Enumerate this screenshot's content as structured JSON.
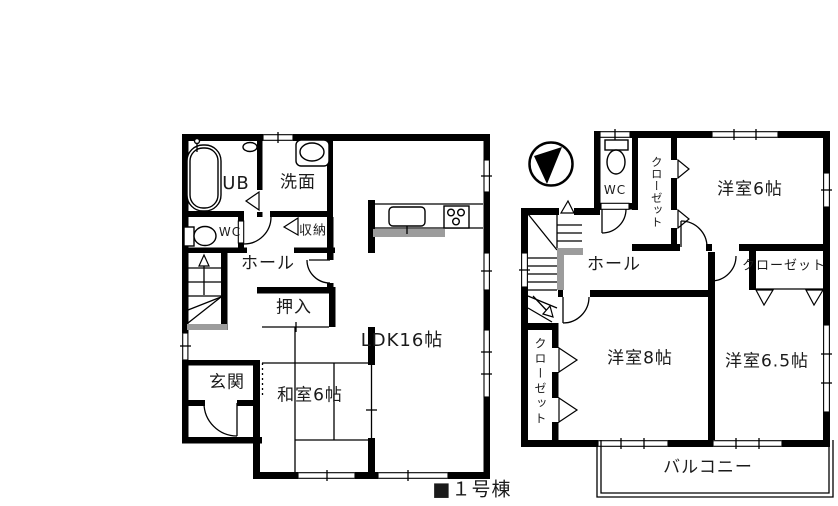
{
  "caption": "■１号棟",
  "colors": {
    "wall": "#000000",
    "background": "#ffffff",
    "accent_gray": "#9c9c9c"
  },
  "floor1": {
    "labels": {
      "ub": "UB",
      "senmen": "洗面",
      "wc": "WC",
      "shuno": "収納",
      "hall": "ホール",
      "oshiire": "押入",
      "washitsu": "和室6帖",
      "ldk": "LDK16帖",
      "genkan": "玄関"
    }
  },
  "floor2": {
    "labels": {
      "wc": "WC",
      "closet_north": "クローゼット",
      "bedroom6": "洋室6帖",
      "hall": "ホール",
      "closet_east": "クローゼット",
      "bedroom8": "洋室8帖",
      "bedroom65": "洋室6.5帖",
      "closet_west": "クローゼット",
      "balcony": "バルコニー"
    }
  }
}
